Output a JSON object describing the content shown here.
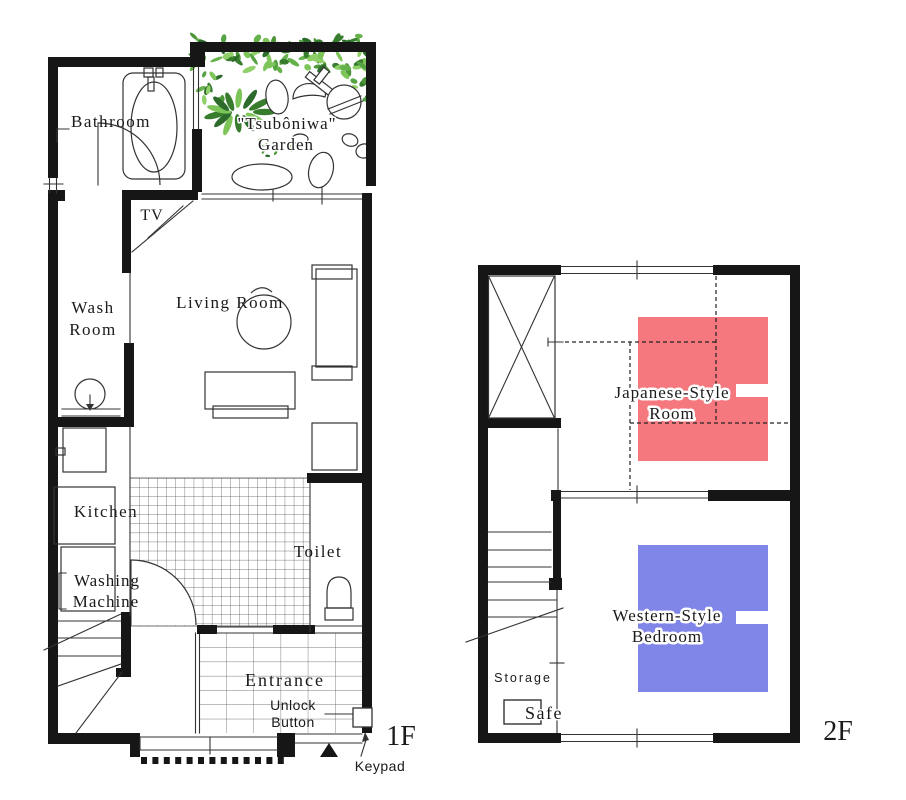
{
  "floor1": {
    "floor_label": "1F",
    "labels": {
      "bathroom": "Bathroom",
      "garden_line1": "\"Tsubôniwa\"",
      "garden_line2": "Garden",
      "tv": "TV",
      "wash_line1": "Wash",
      "wash_line2": "Room",
      "living_room": "Living Room",
      "kitchen": "Kitchen",
      "washing_line1": "Washing",
      "washing_line2": "Machine",
      "toilet": "Toilet",
      "entrance": "Entrance",
      "unlock_line1": "Unlock",
      "unlock_line2": "Button",
      "keypad": "Keypad"
    }
  },
  "floor2": {
    "floor_label": "2F",
    "labels": {
      "japanese_line1": "Japanese-Style",
      "japanese_line2": "Room",
      "western_line1": "Western-Style",
      "western_line2": "Bedroom",
      "storage": "Storage",
      "safe": "Safe"
    }
  },
  "colors": {
    "wall": "#161616",
    "line": "#333333",
    "tile_line": "#4d4d4d",
    "futon_pink": "#F4787E",
    "bed_blue": "#8085E8",
    "leaf_greens": [
      "#66b24a",
      "#4c9638",
      "#387d2d",
      "#7dc558",
      "#2d6b2c",
      "#8fd069",
      "#56a344"
    ]
  }
}
